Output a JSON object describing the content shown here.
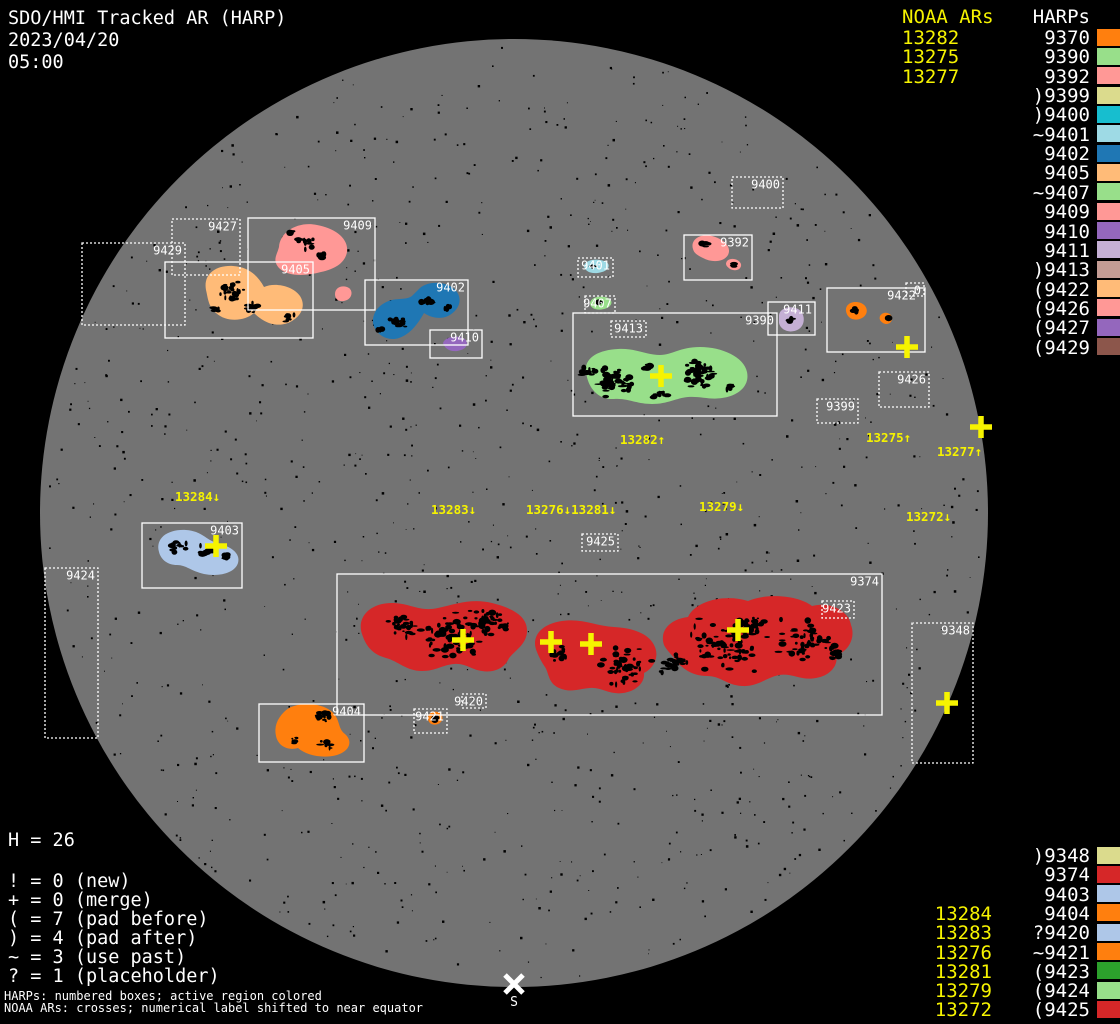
{
  "title": {
    "line1": "SDO/HMI Tracked AR (HARP)",
    "date": "2023/04/20",
    "time": "05:00"
  },
  "colors": {
    "background": "#000000",
    "disk": "#737373",
    "box_stroke": "#ffffff",
    "noaa_yellow": "#f6f300",
    "label_white": "#ffffff"
  },
  "noaa_top": {
    "header": "NOAA ARs",
    "items": [
      "13282",
      "13275",
      "13277"
    ]
  },
  "harp_list_top": {
    "header": "HARPs",
    "items": [
      {
        "label": "9370",
        "color": "#ff7f0e"
      },
      {
        "label": "9390",
        "color": "#98df8a"
      },
      {
        "label": "9392",
        "color": "#ff9896"
      },
      {
        "label": ")9399",
        "color": "#dbdb8d"
      },
      {
        "label": ")9400",
        "color": "#17becf"
      },
      {
        "label": "~9401",
        "color": "#9edae5"
      },
      {
        "label": "9402",
        "color": "#1f77b4"
      },
      {
        "label": "9405",
        "color": "#ffbb78"
      },
      {
        "label": "~9407",
        "color": "#98df8a"
      },
      {
        "label": "9409",
        "color": "#ff9896"
      },
      {
        "label": "9410",
        "color": "#9467bd"
      },
      {
        "label": "9411",
        "color": "#c5b0d5"
      },
      {
        "label": ")9413",
        "color": "#c49c94"
      },
      {
        "label": "(9422",
        "color": "#ffbb78"
      },
      {
        "label": "(9426",
        "color": "#ff9896"
      },
      {
        "label": "(9427",
        "color": "#9467bd"
      },
      {
        "label": "(9429",
        "color": "#8c564b"
      }
    ]
  },
  "harp_list_bottom": {
    "items": [
      {
        "label": ")9348",
        "color": "#dbdb8d"
      },
      {
        "label": "9374",
        "color": "#d62728"
      },
      {
        "label": "9403",
        "color": "#aec7e8"
      },
      {
        "label": "9404",
        "color": "#ff7f0e"
      },
      {
        "label": "?9420",
        "color": "#aec7e8"
      },
      {
        "label": "~9421",
        "color": "#ff7f0e"
      },
      {
        "label": "(9423",
        "color": "#2ca02c"
      },
      {
        "label": "(9424",
        "color": "#98df8a"
      },
      {
        "label": "(9425",
        "color": "#d62728"
      }
    ]
  },
  "noaa_bottom": {
    "items": [
      "13284",
      "13283",
      "13276",
      "13281",
      "13279",
      "13272"
    ],
    "first_row_index": 3
  },
  "counters": {
    "h_line": "H = 26",
    "lines": [
      "! = 0 (new)",
      "+ = 0 (merge)",
      "( = 7 (pad before)",
      ") = 4 (pad after)",
      "~ = 3 (use past)",
      "? = 1 (placeholder)"
    ]
  },
  "footnotes": [
    "HARPs: numbered boxes; active region colored",
    "NOAA ARs: crosses; numerical label shifted to near equator"
  ],
  "south_marker": {
    "label": "S",
    "x": 514,
    "y": 984
  },
  "disk": {
    "cx": 514,
    "cy": 513,
    "r": 474,
    "color": "#737373"
  },
  "chart_data": {
    "type": "heatmap",
    "title": "SDO/HMI Tracked AR (HARP) magnetogram map, 2023/04/20 05:00",
    "harp_total": 26,
    "harps_on_disk": [
      "9348",
      "9370",
      "9374",
      "9390",
      "9392",
      "9399",
      "9400",
      "9401",
      "9402",
      "9403",
      "9404",
      "9405",
      "9407",
      "9409",
      "9410",
      "9411",
      "9413",
      "9420",
      "9421",
      "9422",
      "9423",
      "9424",
      "9425",
      "9426",
      "9427",
      "9429"
    ],
    "noaa_active_regions_north": [
      "13282",
      "13275",
      "13277"
    ],
    "noaa_active_regions_south": [
      "13284",
      "13283",
      "13276",
      "13281",
      "13279",
      "13272"
    ]
  },
  "regions": [
    {
      "harp": "9409",
      "color": "#ff9896",
      "paths": [
        "M279,247 C280,231 299,221 317,225 C334,228 349,238 347,252 C345,263 335,269 321,272 C306,276 288,277 279,268 C272,260 277,255 279,247 Z",
        "M335,294 C335,288 341,285 347,287 C353,289 353,297 347,300 C340,303 335,300 335,294 Z"
      ]
    },
    {
      "harp": "9405",
      "color": "#ffbb78",
      "paths": [
        "M206,290 C203,274 216,265 233,266 C249,267 258,276 264,287 C275,282 293,286 300,296 C307,307 300,318 288,323 C274,328 262,321 254,313 C245,321 227,323 216,313 C208,306 208,298 206,290 Z"
      ]
    },
    {
      "harp": "9402",
      "color": "#1f77b4",
      "paths": [
        "M420,288 C429,280 449,281 457,292 C463,301 458,311 448,316 C439,320 430,317 424,313 C419,322 411,334 399,338 C387,342 375,334 373,323 C372,312 380,303 392,300 C401,298 408,300 413,295 C416,292 418,290 420,288 Z"
      ]
    },
    {
      "harp": "9410",
      "color": "#9467bd",
      "paths": [
        "M443,343 C445,337 456,335 463,338 C469,341 468,348 461,350 C453,353 445,350 443,343 Z"
      ]
    },
    {
      "harp": "9392",
      "color": "#ff9896",
      "paths": [
        "M693,249 C690,240 700,233 712,236 C724,239 732,247 728,255 C724,262 712,263 703,258 C697,255 694,253 693,249 Z",
        "M727,261 C731,257 739,259 741,264 C742,269 736,272 730,269 C726,266 725,264 727,261 Z"
      ]
    },
    {
      "harp": "9401",
      "color": "#9edae5",
      "paths": [
        "M584,266 C585,260 596,258 604,261 C611,263 610,270 602,272 C593,275 585,272 584,266 Z"
      ]
    },
    {
      "harp": "9407",
      "color": "#98df8a",
      "paths": [
        "M590,303 C591,297 601,295 608,298 C614,301 612,307 604,309 C596,311 590,308 590,303 Z"
      ]
    },
    {
      "harp": "9390",
      "color": "#98df8a",
      "paths": [
        "M586,372 C584,358 598,350 618,349 C636,348 646,355 660,355 C672,355 680,347 700,347 C722,347 744,357 747,372 C750,386 738,396 722,398 C710,400 700,396 688,397 C676,398 668,404 652,404 C636,404 628,398 614,399 C598,400 588,388 586,372 Z"
      ]
    },
    {
      "harp": "9411",
      "color": "#c5b0d5",
      "paths": [
        "M779,315 C780,308 790,305 798,309 C805,313 806,324 799,329 C791,334 781,331 779,323 Z"
      ]
    },
    {
      "harp": "9370",
      "color": "#ff7f0e",
      "paths": [
        "M846,311 C845,304 853,300 861,303 C868,306 869,314 862,318 C854,322 847,318 846,311 Z",
        "M880,316 C883,311 890,312 892,317 C893,322 888,326 883,323 C880,321 879,319 880,316 Z"
      ]
    },
    {
      "harp": "9403",
      "color": "#aec7e8",
      "paths": [
        "M159,552 C155,538 168,529 186,530 C202,531 206,540 217,543 C230,546 241,553 238,563 C235,573 219,577 204,574 C191,571 186,565 177,565 C168,565 161,560 159,552 Z"
      ]
    },
    {
      "harp": "9404",
      "color": "#ff7f0e",
      "paths": [
        "M284,712 C294,701 320,702 331,711 C341,719 337,728 345,734 C353,741 350,751 337,755 C322,759 306,755 298,748 C288,751 278,746 276,736 C274,727 277,719 284,712 Z"
      ]
    },
    {
      "harp": "9421",
      "color": "#ff7f0e",
      "paths": [
        "M428,718 C428,712 435,710 440,713 C444,716 443,722 438,724 C432,726 428,723 428,718 Z"
      ]
    },
    {
      "harp": "9374",
      "color": "#d62728",
      "paths": [
        "M362,634 C356,616 372,602 394,603 C412,604 420,612 438,608 C456,604 472,598 492,603 C512,608 528,616 527,632 C526,646 512,652 508,660 C504,668 494,673 482,671 C472,670 466,663 454,664 C442,665 436,671 422,671 C406,671 398,661 386,658 C372,654 366,646 362,634 Z",
        "M537,652 C530,636 542,624 562,621 C582,618 596,626 614,627 C632,628 648,633 654,645 C660,656 654,668 644,673 C645,682 637,691 623,693 C609,695 602,687 590,688 C578,689 570,693 559,688 C548,683 549,673 545,667 C541,661 539,657 537,652 Z",
        "M664,645 C659,630 671,619 688,617 C696,600 726,594 748,601 C766,593 798,595 812,606 C830,601 849,611 851,625 C856,638 848,652 836,655 C839,665 830,676 816,678 C801,681 793,673 779,675 C765,678 758,687 742,686 C726,685 721,676 707,676 C692,676 681,668 675,659 C669,652 666,649 664,645 Z"
      ]
    }
  ],
  "spot_clusters": [
    {
      "x": 305,
      "y": 243,
      "r": 10,
      "n": 14
    },
    {
      "x": 322,
      "y": 256,
      "r": 6,
      "n": 7
    },
    {
      "x": 290,
      "y": 232,
      "r": 4,
      "n": 4
    },
    {
      "x": 232,
      "y": 292,
      "r": 14,
      "n": 24
    },
    {
      "x": 252,
      "y": 308,
      "r": 8,
      "n": 10
    },
    {
      "x": 288,
      "y": 318,
      "r": 7,
      "n": 8
    },
    {
      "x": 215,
      "y": 310,
      "r": 5,
      "n": 5
    },
    {
      "x": 398,
      "y": 322,
      "r": 10,
      "n": 14
    },
    {
      "x": 428,
      "y": 300,
      "r": 8,
      "n": 10
    },
    {
      "x": 448,
      "y": 308,
      "r": 4,
      "n": 5
    },
    {
      "x": 380,
      "y": 330,
      "r": 4,
      "n": 4
    },
    {
      "x": 706,
      "y": 244,
      "r": 5,
      "n": 6
    },
    {
      "x": 733,
      "y": 265,
      "r": 3,
      "n": 3
    },
    {
      "x": 592,
      "y": 266,
      "r": 3,
      "n": 3
    },
    {
      "x": 600,
      "y": 303,
      "r": 3,
      "n": 3
    },
    {
      "x": 612,
      "y": 382,
      "r": 22,
      "n": 55
    },
    {
      "x": 588,
      "y": 372,
      "r": 8,
      "n": 10
    },
    {
      "x": 700,
      "y": 374,
      "r": 20,
      "n": 48
    },
    {
      "x": 660,
      "y": 395,
      "r": 8,
      "n": 10
    },
    {
      "x": 648,
      "y": 368,
      "r": 6,
      "n": 8
    },
    {
      "x": 730,
      "y": 388,
      "r": 6,
      "n": 8
    },
    {
      "x": 790,
      "y": 320,
      "r": 4,
      "n": 5
    },
    {
      "x": 856,
      "y": 310,
      "r": 4,
      "n": 5
    },
    {
      "x": 888,
      "y": 318,
      "r": 2,
      "n": 2
    },
    {
      "x": 178,
      "y": 547,
      "r": 9,
      "n": 12
    },
    {
      "x": 206,
      "y": 550,
      "r": 8,
      "n": 12
    },
    {
      "x": 226,
      "y": 556,
      "r": 5,
      "n": 6
    },
    {
      "x": 322,
      "y": 716,
      "r": 9,
      "n": 12
    },
    {
      "x": 294,
      "y": 740,
      "r": 6,
      "n": 7
    },
    {
      "x": 326,
      "y": 745,
      "r": 7,
      "n": 9
    },
    {
      "x": 435,
      "y": 718,
      "r": 3,
      "n": 3
    },
    {
      "x": 455,
      "y": 635,
      "r": 35,
      "n": 75
    },
    {
      "x": 490,
      "y": 625,
      "r": 22,
      "n": 40
    },
    {
      "x": 400,
      "y": 630,
      "r": 18,
      "n": 25
    },
    {
      "x": 560,
      "y": 655,
      "r": 12,
      "n": 12
    },
    {
      "x": 625,
      "y": 665,
      "r": 28,
      "n": 48
    },
    {
      "x": 672,
      "y": 662,
      "r": 18,
      "n": 25
    },
    {
      "x": 722,
      "y": 645,
      "r": 38,
      "n": 85
    },
    {
      "x": 752,
      "y": 625,
      "r": 18,
      "n": 25
    },
    {
      "x": 805,
      "y": 640,
      "r": 28,
      "n": 48
    },
    {
      "x": 838,
      "y": 652,
      "r": 10,
      "n": 12
    }
  ],
  "boxes": [
    {
      "harp": "9409",
      "label": "9409",
      "x": 248,
      "y": 218,
      "w": 127,
      "h": 92,
      "style": "solid"
    },
    {
      "harp": "9405",
      "label": "9405",
      "x": 165,
      "y": 262,
      "w": 148,
      "h": 76,
      "style": "solid"
    },
    {
      "harp": "9402",
      "label": "9402",
      "x": 365,
      "y": 280,
      "w": 103,
      "h": 65,
      "style": "solid"
    },
    {
      "harp": "9410",
      "label": "9410",
      "x": 430,
      "y": 330,
      "w": 52,
      "h": 28,
      "style": "solid"
    },
    {
      "harp": "9392",
      "label": "9392",
      "x": 684,
      "y": 235,
      "w": 68,
      "h": 45,
      "style": "solid"
    },
    {
      "harp": "9411",
      "label": "9411",
      "x": 768,
      "y": 302,
      "w": 47,
      "h": 33,
      "style": "solid"
    },
    {
      "harp": "9390",
      "label": "9390",
      "x": 573,
      "y": 313,
      "w": 204,
      "h": 103,
      "style": "solid"
    },
    {
      "harp": "9422",
      "label": "9422",
      "x": 827,
      "y": 288,
      "w": 98,
      "h": 64,
      "style": "solid",
      "label_x_end": 916
    },
    {
      "harp": "9403",
      "label": "9403",
      "x": 142,
      "y": 523,
      "w": 100,
      "h": 65,
      "style": "solid"
    },
    {
      "harp": "9404",
      "label": "9404",
      "x": 259,
      "y": 704,
      "w": 105,
      "h": 58,
      "style": "solid"
    },
    {
      "harp": "9374",
      "label": "9374",
      "x": 337,
      "y": 574,
      "w": 545,
      "h": 141,
      "style": "solid"
    },
    {
      "harp": "9427",
      "label": "9427",
      "x": 172,
      "y": 219,
      "w": 68,
      "h": 56,
      "style": "dotted"
    },
    {
      "harp": "9429",
      "label": "9429",
      "x": 82,
      "y": 243,
      "w": 103,
      "h": 82,
      "style": "dotted"
    },
    {
      "harp": "9400",
      "label": "9400",
      "x": 732,
      "y": 177,
      "w": 51,
      "h": 31,
      "style": "dotted"
    },
    {
      "harp": "9401",
      "label": "9401",
      "x": 578,
      "y": 258,
      "w": 35,
      "h": 19,
      "style": "dotted"
    },
    {
      "harp": "9407",
      "label": "9407",
      "x": 585,
      "y": 296,
      "w": 30,
      "h": 17,
      "style": "dotted"
    },
    {
      "harp": "9426",
      "label": "9426",
      "x": 879,
      "y": 372,
      "w": 50,
      "h": 35,
      "style": "dotted"
    },
    {
      "harp": "9399",
      "label": "9399",
      "x": 817,
      "y": 399,
      "w": 41,
      "h": 24,
      "style": "dotted"
    },
    {
      "harp": "9424",
      "label": "9424",
      "x": 45,
      "y": 568,
      "w": 53,
      "h": 170,
      "style": "dotted"
    },
    {
      "harp": "9348",
      "label": "9348",
      "x": 912,
      "y": 623,
      "w": 61,
      "h": 140,
      "style": "dotted"
    },
    {
      "harp": "9421",
      "label": "9421",
      "x": 414,
      "y": 709,
      "w": 33,
      "h": 24,
      "style": "dotted"
    },
    {
      "harp": "9420",
      "label": "9420",
      "x": 462,
      "y": 694,
      "w": 24,
      "h": 14,
      "style": "dotted"
    },
    {
      "harp": "9413",
      "label": "9413",
      "x": 611,
      "y": 321,
      "w": 35,
      "h": 16,
      "style": "dotted"
    },
    {
      "harp": "9425",
      "label": "9425",
      "x": 582,
      "y": 534,
      "w": 36,
      "h": 17,
      "style": "dotted"
    },
    {
      "harp": "9423",
      "label": "9423",
      "x": 822,
      "y": 601,
      "w": 32,
      "h": 17,
      "style": "dotted"
    },
    {
      "harp": "9370",
      "label": "0",
      "x": 906,
      "y": 283,
      "w": 18,
      "h": 13,
      "style": "dotted"
    }
  ],
  "crosses": [
    {
      "x": 216,
      "y": 546
    },
    {
      "x": 463,
      "y": 640
    },
    {
      "x": 551,
      "y": 642
    },
    {
      "x": 591,
      "y": 644
    },
    {
      "x": 738,
      "y": 630
    },
    {
      "x": 661,
      "y": 376
    },
    {
      "x": 907,
      "y": 347
    },
    {
      "x": 981,
      "y": 427
    },
    {
      "x": 947,
      "y": 703
    }
  ],
  "noaa_disk_labels": [
    {
      "text": "13282↑",
      "x": 620,
      "y": 433
    },
    {
      "text": "13275↑",
      "x": 866,
      "y": 431
    },
    {
      "text": "13277↑",
      "x": 937,
      "y": 445
    },
    {
      "text": "13284↓",
      "x": 175,
      "y": 490
    },
    {
      "text": "13283↓",
      "x": 431,
      "y": 503
    },
    {
      "text": "13276↓13281↓",
      "x": 526,
      "y": 503
    },
    {
      "text": "13279↓",
      "x": 699,
      "y": 500
    },
    {
      "text": "13272↓",
      "x": 906,
      "y": 510
    }
  ]
}
